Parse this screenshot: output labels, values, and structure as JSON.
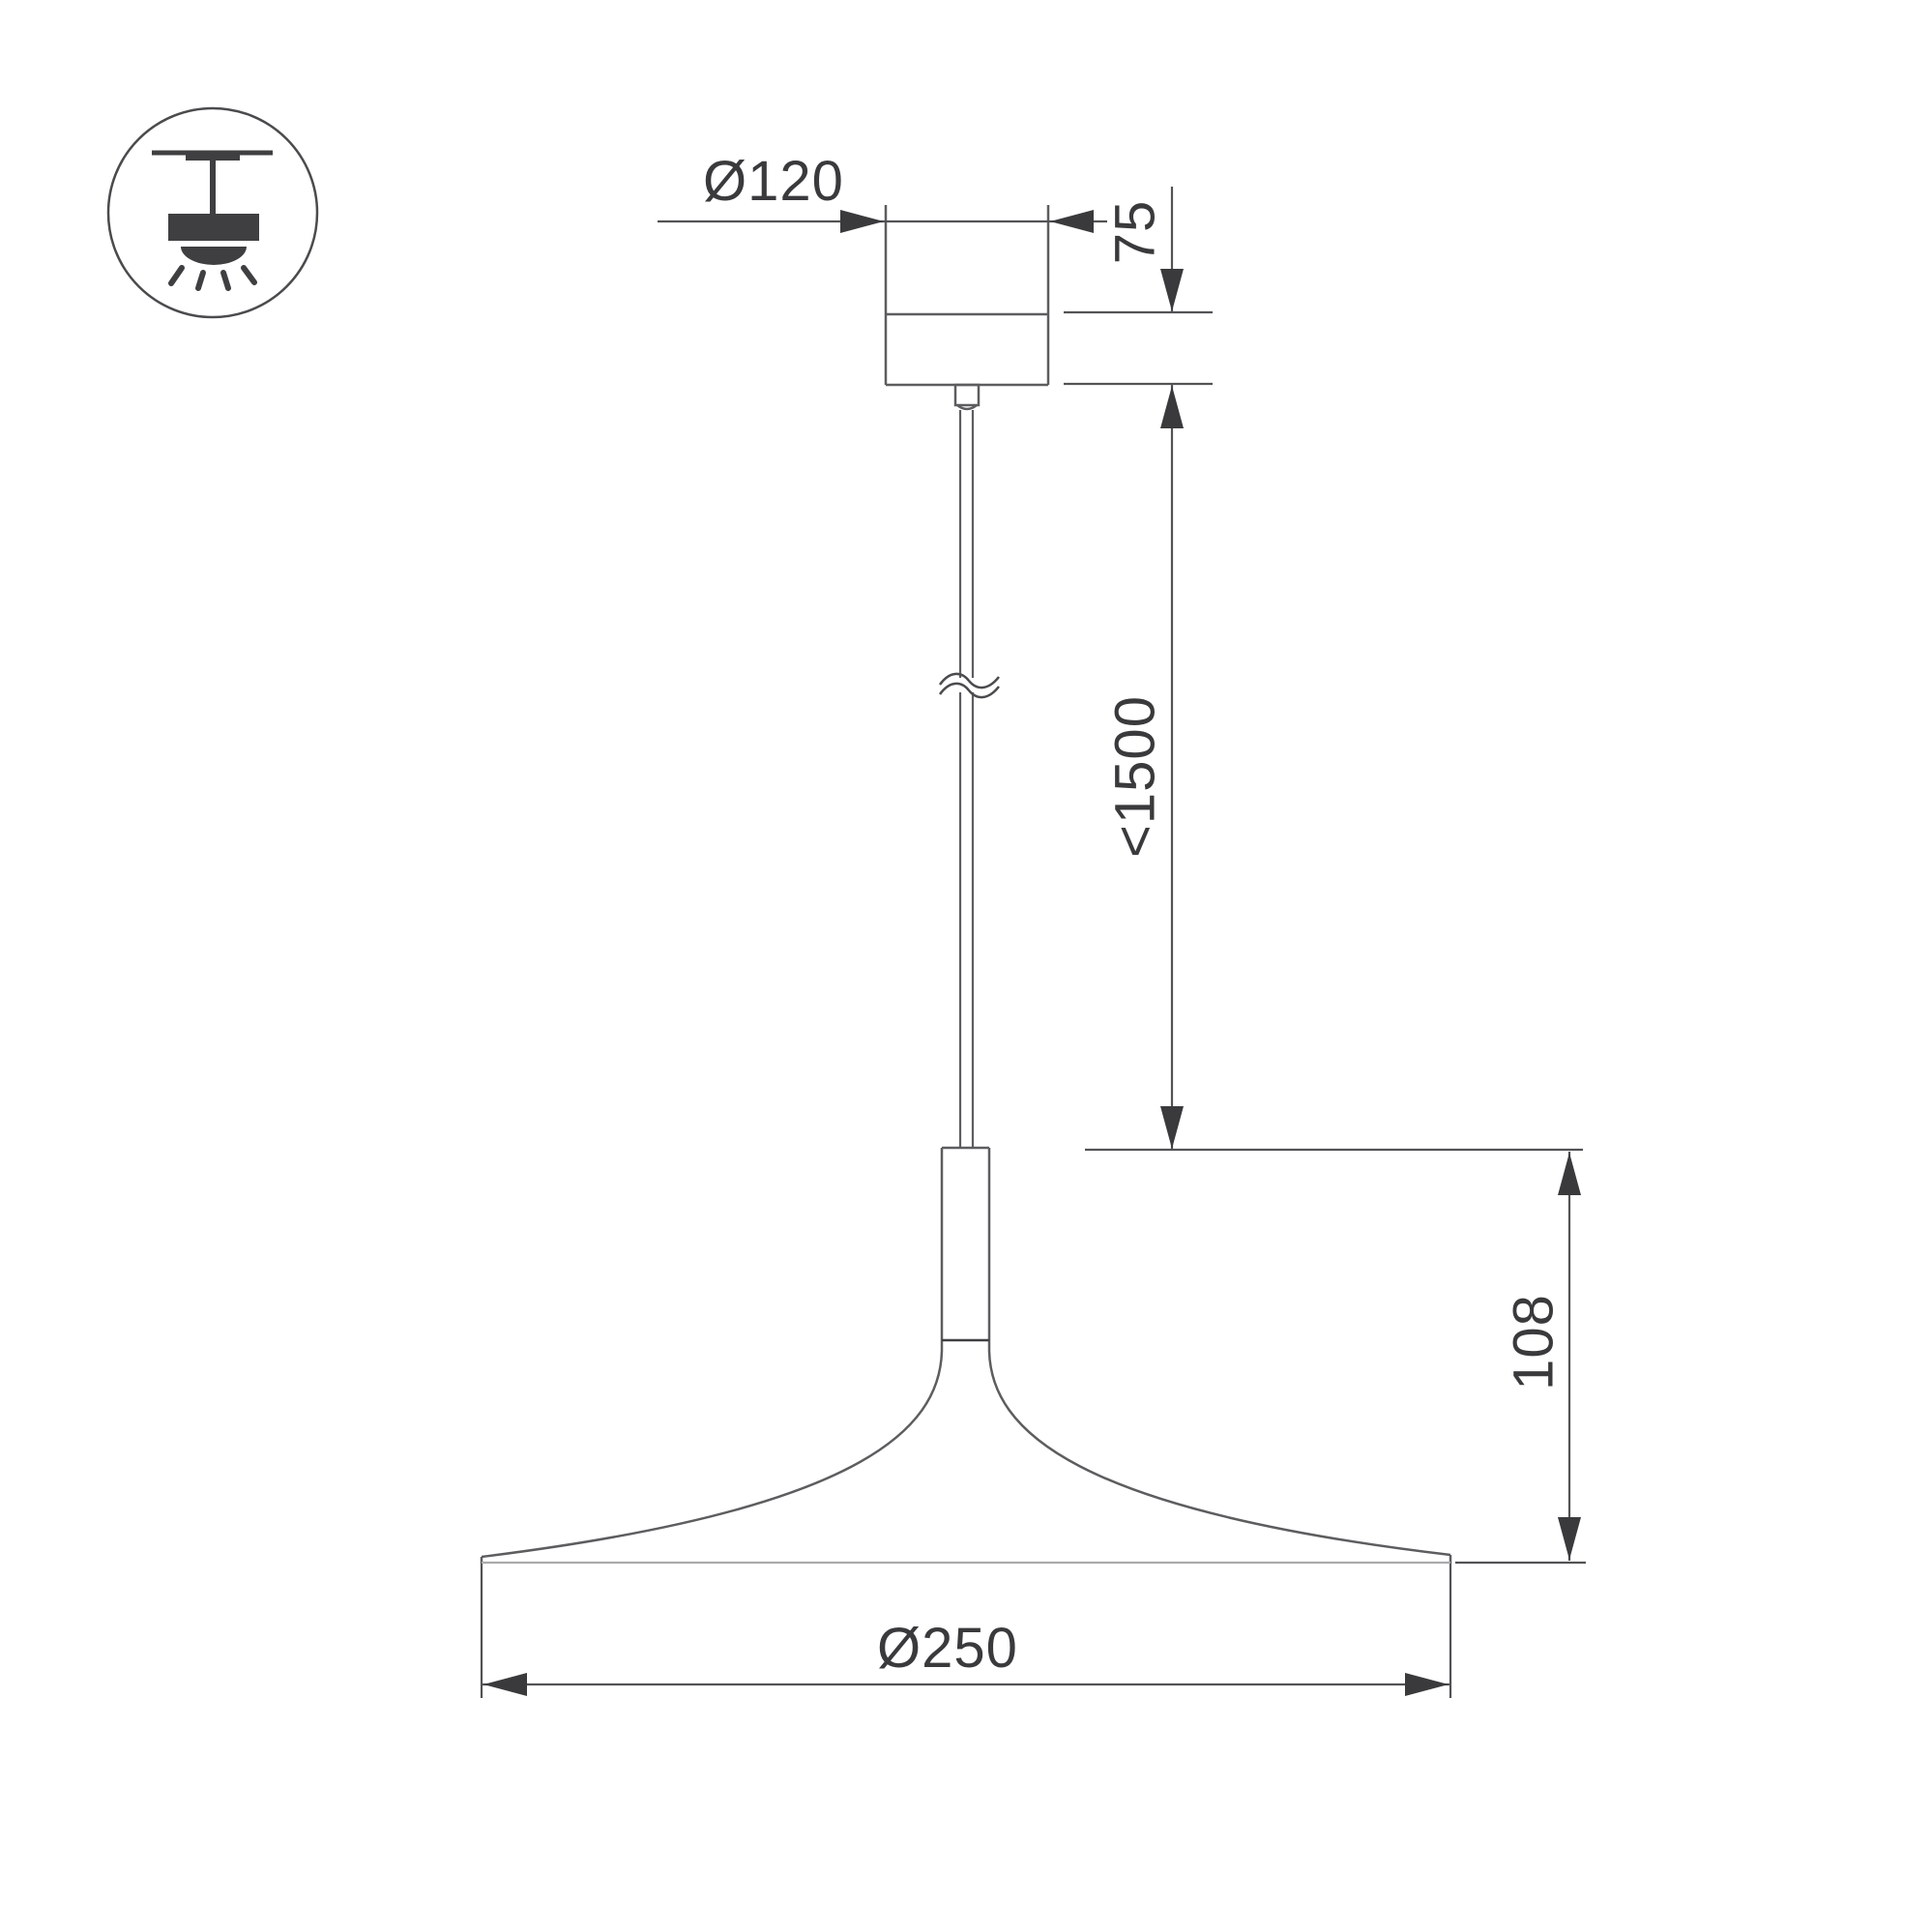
{
  "drawing": {
    "type": "pendant-lamp-dimensional-drawing",
    "dims": {
      "canopy_diameter": {
        "label": "Ø120"
      },
      "canopy_height": {
        "label": "75"
      },
      "suspension": {
        "label": "<1500"
      },
      "lamp_height": {
        "label": "108"
      },
      "shade_diameter": {
        "label": "Ø250"
      }
    },
    "icon": {
      "name": "pendant-mounting-icon"
    },
    "colors": {
      "outline": "#5d5d60",
      "dimension_line": "#535356",
      "arrow_and_text": "#3a3a3d",
      "light_line": "#ababad",
      "background": "#ffffff"
    }
  }
}
